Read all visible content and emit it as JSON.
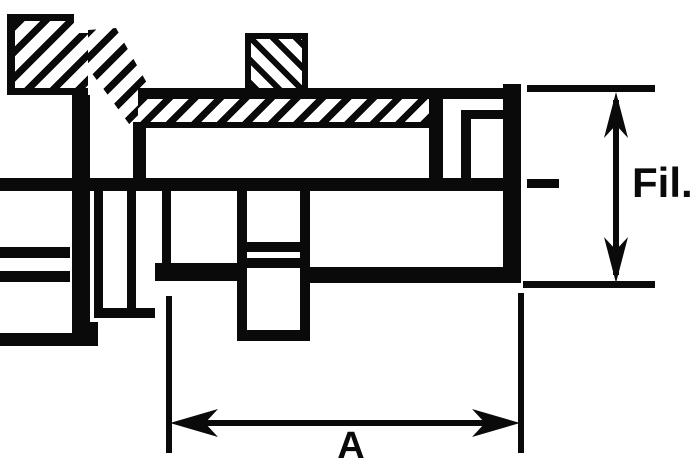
{
  "drawing": {
    "type": "technical-section-drawing",
    "dimensions": {
      "fil": {
        "label": "Fil."
      },
      "a": {
        "label": "A"
      }
    },
    "colors": {
      "line": "#0a0a0a",
      "background": "#ffffff"
    }
  }
}
